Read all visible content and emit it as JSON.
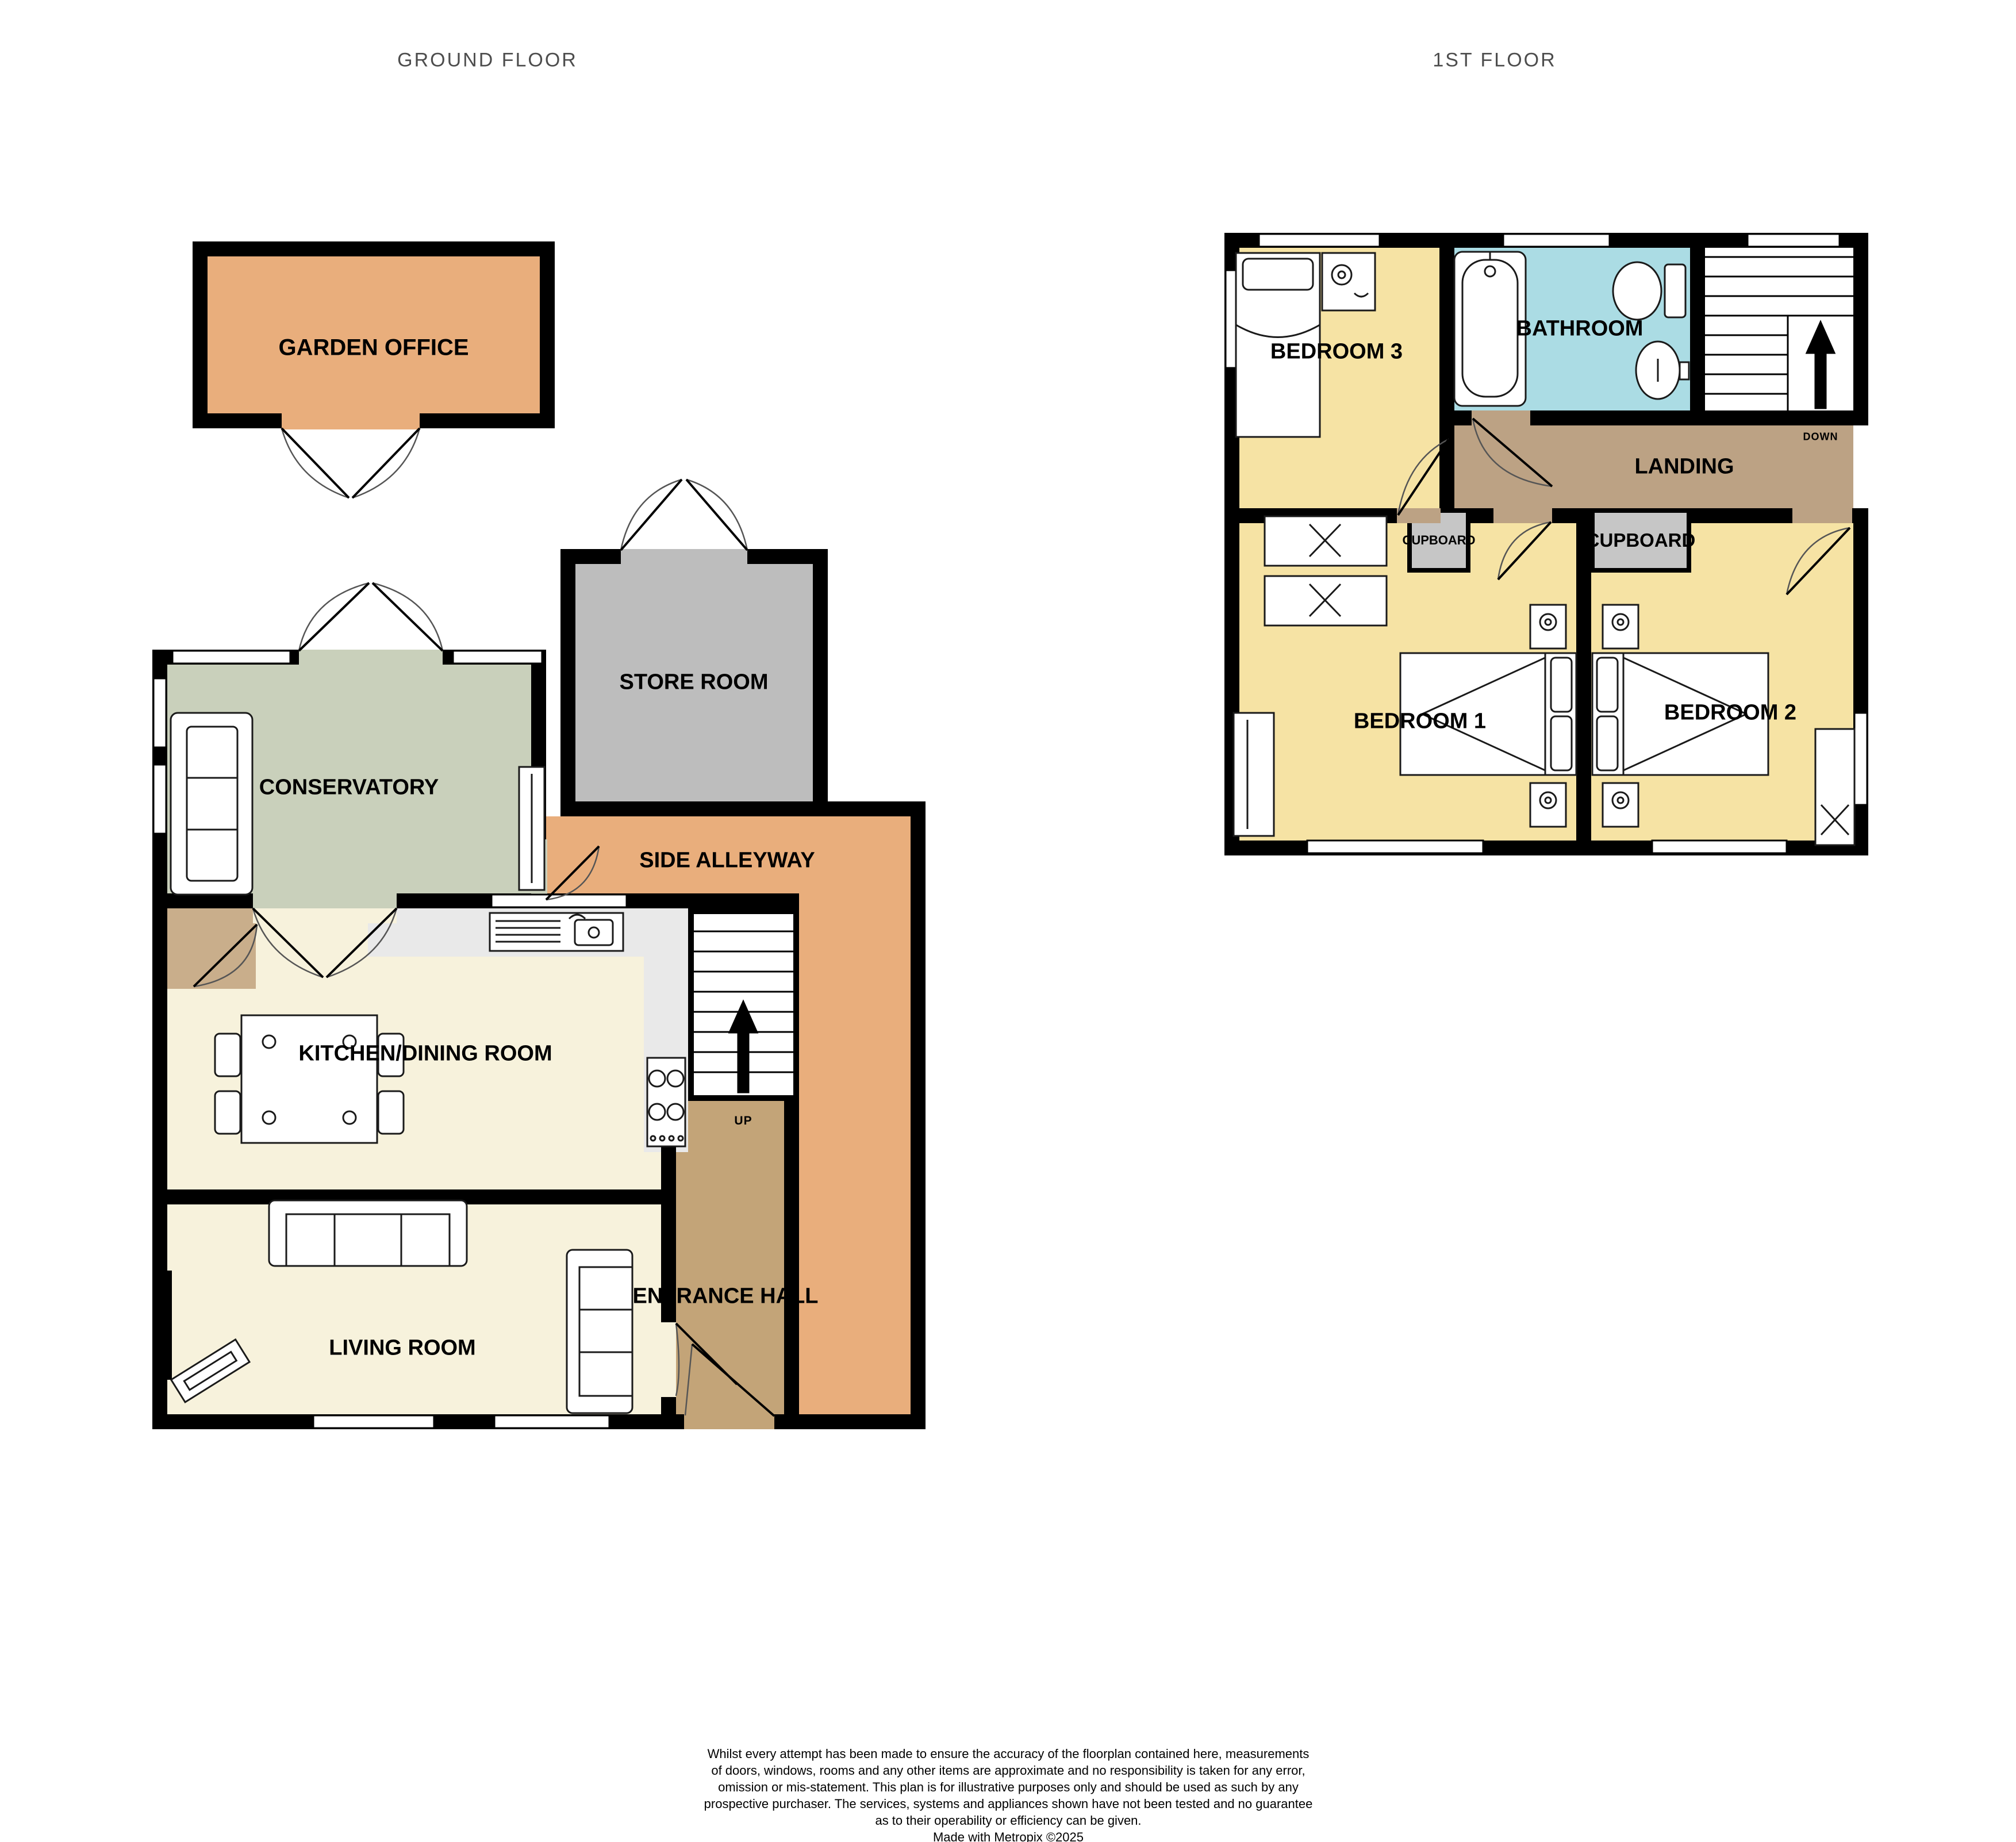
{
  "titles": {
    "ground": "GROUND FLOOR",
    "first": "1ST FLOOR"
  },
  "ground_floor": {
    "garden_office": "GARDEN OFFICE",
    "store_room": "STORE ROOM",
    "conservatory": "CONSERVATORY",
    "side_alleyway": "SIDE ALLEYWAY",
    "kitchen_dining": "KITCHEN/DINING ROOM",
    "entrance_hall": "ENTRANCE HALL",
    "living_room": "LIVING ROOM",
    "stairs_direction": "UP"
  },
  "first_floor": {
    "bedroom_3": "BEDROOM 3",
    "bathroom": "BATHROOM",
    "landing": "LANDING",
    "cupboard_1": "CUPBOARD",
    "cupboard_2": "CUPBOARD",
    "bedroom_1": "BEDROOM 1",
    "bedroom_2": "BEDROOM 2",
    "stairs_direction": "DOWN"
  },
  "disclaimer": {
    "lines": [
      "Whilst every attempt has been made to ensure the accuracy of the floorplan contained here, measurements",
      "of doors, windows, rooms and any other items are approximate and no responsibility is taken for any error,",
      "omission or mis-statement. This plan is for illustrative purposes only and should be used as such by any",
      "prospective purchaser. The services, systems and appliances shown have not been tested and no guarantee",
      "as to their operability or efficiency can be given."
    ],
    "credit": "Made with Metropix ©2025"
  },
  "colors": {
    "wall": "#000000",
    "garden_office_fill": "#e9ae7c",
    "side_alleyway_fill": "#e9ae7c",
    "store_room_fill": "#bdbdbd",
    "conservatory_fill": "#c9d0bb",
    "kitchen_living_fill": "#f7f2dc",
    "entrance_hall_fill": "#c3a478",
    "landing_fill": "#bca284",
    "bedroom_fill": "#f6e3a4",
    "bathroom_fill": "#abdce4",
    "cupboard_fill": "#c6c6c6",
    "counter_fill": "#e9e9e9",
    "title_text": "#4d4d4d"
  }
}
